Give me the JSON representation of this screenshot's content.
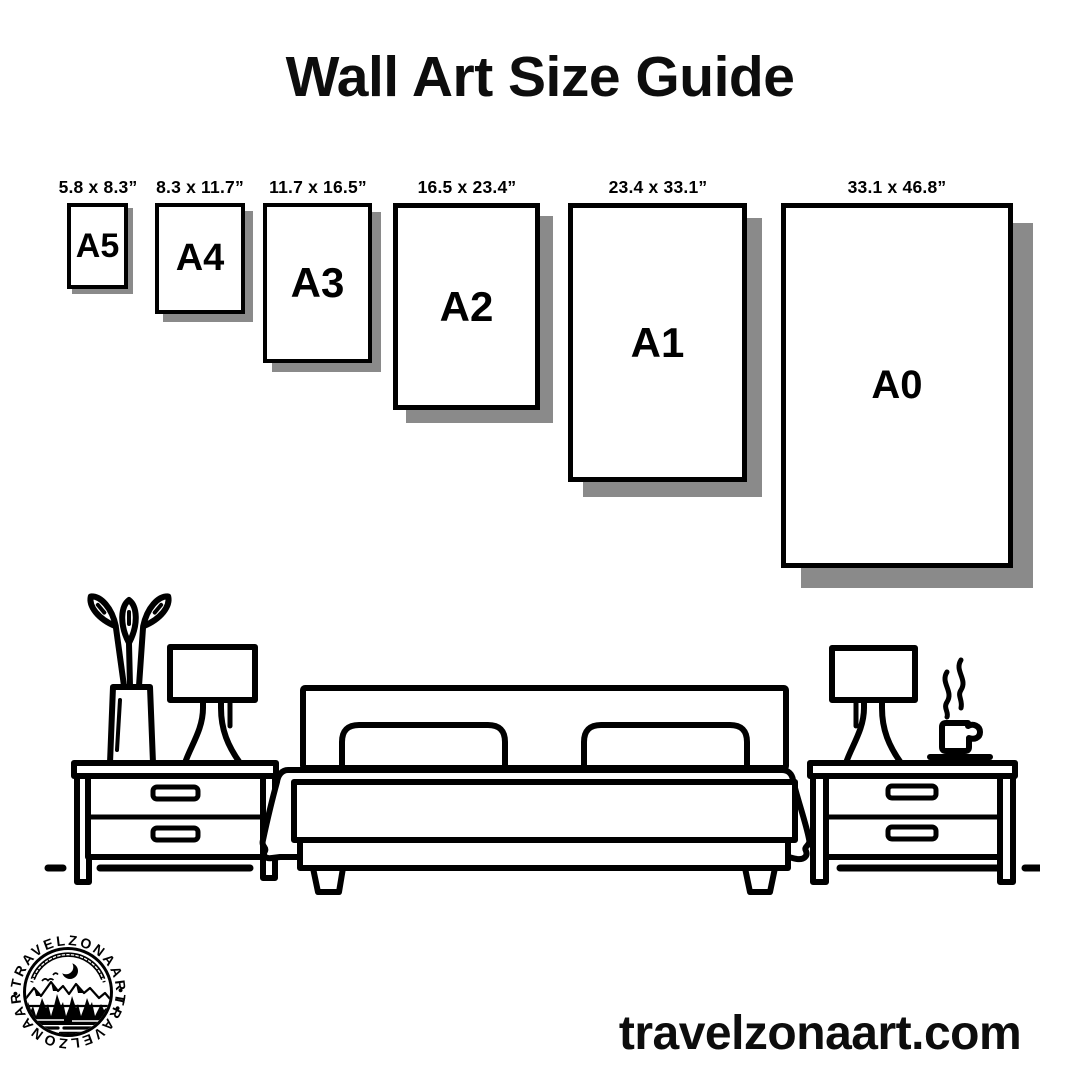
{
  "title": "Wall Art Size Guide",
  "sizes": [
    {
      "label": "A5",
      "dimensions": "5.8 x 8.3”"
    },
    {
      "label": "A4",
      "dimensions": "8.3 x 11.7”"
    },
    {
      "label": "A3",
      "dimensions": "11.7 x 16.5”"
    },
    {
      "label": "A2",
      "dimensions": "16.5 x 23.4”"
    },
    {
      "label": "A1",
      "dimensions": "23.4 x 33.1”"
    },
    {
      "label": "A0",
      "dimensions": "33.1 x 46.8”"
    }
  ],
  "scene": {
    "icons": [
      "plant-vase-icon",
      "table-lamp-icon",
      "nightstand-icon",
      "double-bed-icon",
      "coffee-cup-icon"
    ]
  },
  "logo": {
    "ring_text": "•TRAVELZONAART•"
  },
  "footer": {
    "website": "travelzonaart.com"
  },
  "colors": {
    "ink": "#000000",
    "shadow": "#8a8a8a",
    "background": "#ffffff"
  }
}
